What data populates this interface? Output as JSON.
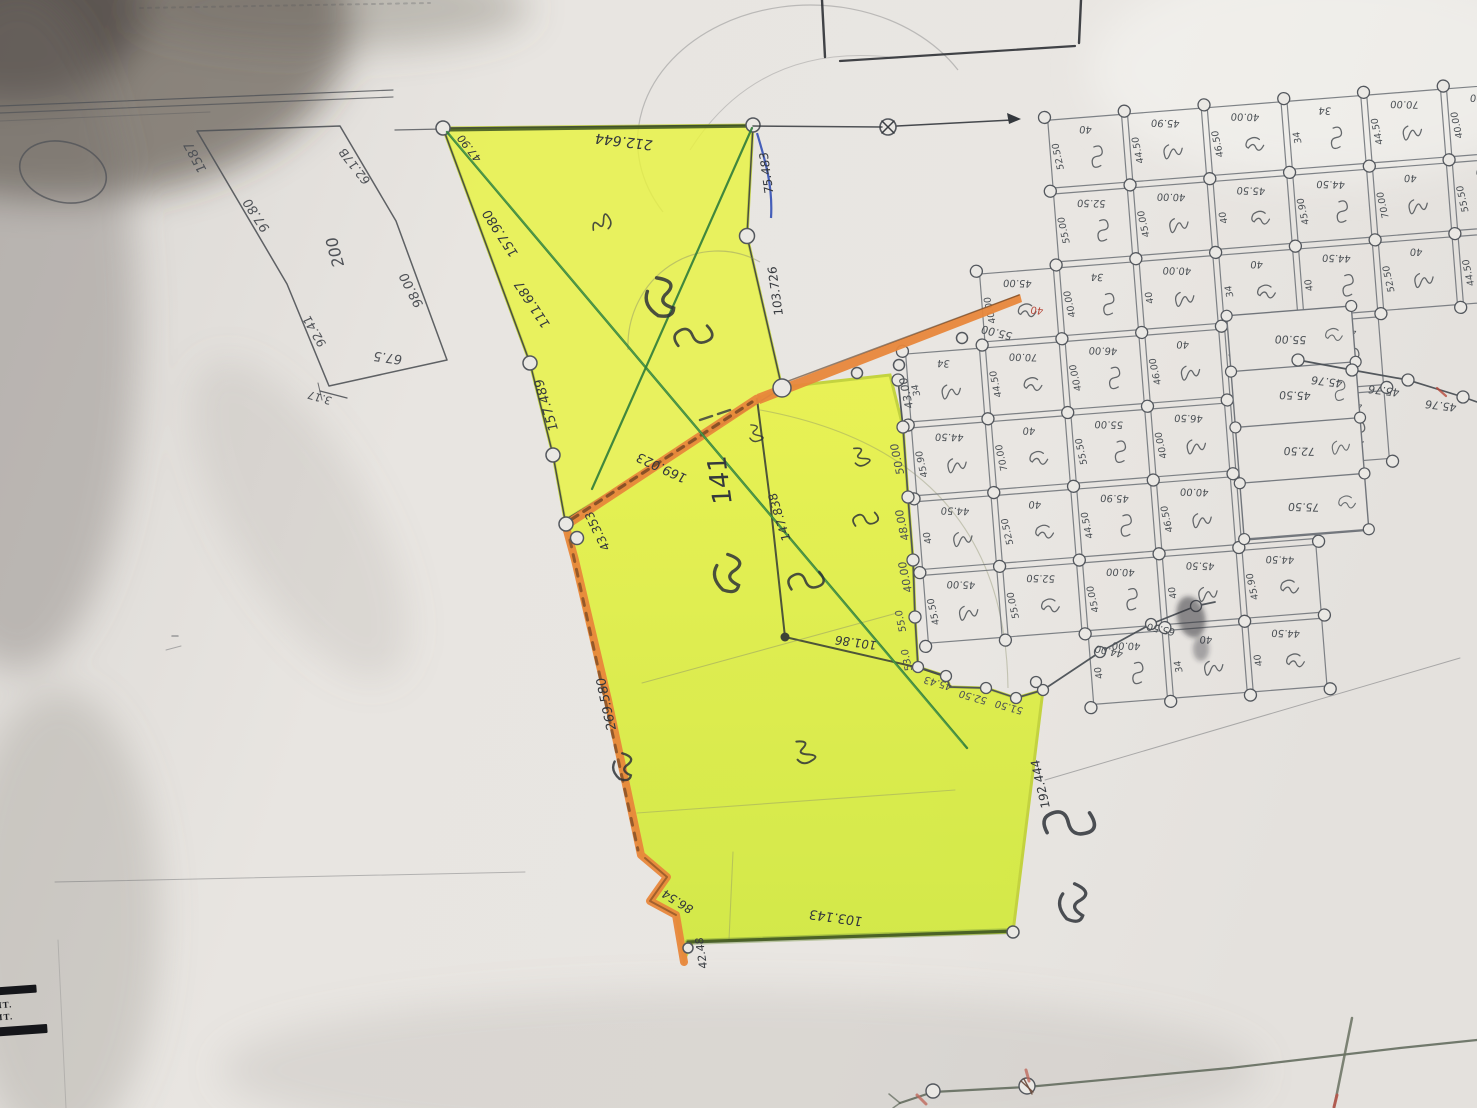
{
  "photo": {
    "description": "hand-drawn cadastral survey map, highlighted parcels"
  },
  "colors": {
    "paper": "#e7e4e0",
    "pencil": "#4f5257",
    "ink": "#34383d",
    "gridInk": "#4b5055",
    "yellow": "#e9f43e",
    "yellowDeep": "#cfe92f",
    "orange": "#e8873b",
    "orangeDark": "#744522",
    "green": "#2f7d3a",
    "blue": "#3350b5",
    "darkGreenEdge": "#3d5422",
    "red": "#b84a3c"
  },
  "stamp": {
    "line1": "ΔIT.",
    "line2": "ΔIT."
  },
  "labels": [
    {
      "t": "1587",
      "x": 196,
      "y": 157,
      "r": 242,
      "s": 13,
      "c": "pencil"
    },
    {
      "t": "97.80",
      "x": 257,
      "y": 215,
      "r": 237,
      "s": 13,
      "c": "pencil"
    },
    {
      "t": "62.17B",
      "x": 355,
      "y": 166,
      "r": 232,
      "s": 12,
      "c": "pencil"
    },
    {
      "t": "200",
      "x": 336,
      "y": 252,
      "r": 255,
      "s": 16,
      "c": "pencil"
    },
    {
      "t": "98.00",
      "x": 412,
      "y": 290,
      "r": 243,
      "s": 13,
      "c": "pencil"
    },
    {
      "t": "92.41",
      "x": 315,
      "y": 331,
      "r": 240,
      "s": 12,
      "c": "pencil"
    },
    {
      "t": "67.5",
      "x": 388,
      "y": 357,
      "r": 188,
      "s": 13,
      "c": "pencil"
    },
    {
      "t": "3.17",
      "x": 320,
      "y": 397,
      "r": 196,
      "s": 11,
      "c": "pencil"
    },
    {
      "t": "212.644",
      "x": 624,
      "y": 141,
      "r": 187,
      "s": 14,
      "c": "ink"
    },
    {
      "t": "47.90",
      "x": 470,
      "y": 148,
      "r": 232,
      "s": 11,
      "c": "ink"
    },
    {
      "t": "157.980",
      "x": 501,
      "y": 233,
      "r": 237,
      "s": 13,
      "c": "ink"
    },
    {
      "t": "111.687",
      "x": 533,
      "y": 304,
      "r": 237,
      "s": 13,
      "c": "ink"
    },
    {
      "t": "157.489",
      "x": 547,
      "y": 405,
      "r": 253,
      "s": 13,
      "c": "ink"
    },
    {
      "t": "75.483",
      "x": 767,
      "y": 173,
      "r": 262,
      "s": 12,
      "c": "ink"
    },
    {
      "t": "103.726",
      "x": 776,
      "y": 291,
      "r": 262,
      "s": 12,
      "c": "ink"
    },
    {
      "t": "169.023",
      "x": 662,
      "y": 467,
      "r": 205,
      "s": 13,
      "c": "ink"
    },
    {
      "t": "43.353",
      "x": 598,
      "y": 531,
      "r": 244,
      "s": 12,
      "c": "ink"
    },
    {
      "t": "141",
      "x": 721,
      "y": 480,
      "r": 262,
      "s": 26,
      "c": "ink"
    },
    {
      "t": "147.838",
      "x": 780,
      "y": 517,
      "r": 253,
      "s": 12,
      "c": "ink"
    },
    {
      "t": "101.86",
      "x": 856,
      "y": 642,
      "r": 188,
      "s": 12,
      "c": "ink"
    },
    {
      "t": "269.580",
      "x": 607,
      "y": 704,
      "r": 258,
      "s": 13,
      "c": "ink"
    },
    {
      "t": "192.444",
      "x": 1041,
      "y": 784,
      "r": 257,
      "s": 12,
      "c": "ink"
    },
    {
      "t": "86.54",
      "x": 678,
      "y": 901,
      "r": 212,
      "s": 12,
      "c": "ink"
    },
    {
      "t": "42.48",
      "x": 702,
      "y": 953,
      "r": 262,
      "s": 11,
      "c": "ink"
    },
    {
      "t": "103.143",
      "x": 836,
      "y": 917,
      "r": 188,
      "s": 13,
      "c": "ink"
    },
    {
      "t": "55.00",
      "x": 997,
      "y": 332,
      "r": 194,
      "s": 11,
      "c": "gridInk"
    },
    {
      "t": "43.00",
      "x": 907,
      "y": 393,
      "r": 258,
      "s": 11,
      "c": "gridInk"
    },
    {
      "t": "50.00",
      "x": 898,
      "y": 459,
      "r": 258,
      "s": 11,
      "c": "gridInk"
    },
    {
      "t": "48.00",
      "x": 903,
      "y": 525,
      "r": 258,
      "s": 11,
      "c": "gridInk"
    },
    {
      "t": "40.00",
      "x": 906,
      "y": 577,
      "r": 258,
      "s": 11,
      "c": "gridInk"
    },
    {
      "t": "55.0",
      "x": 901,
      "y": 621,
      "r": 258,
      "s": 10,
      "c": "gridInk"
    },
    {
      "t": "53.0",
      "x": 907,
      "y": 660,
      "r": 258,
      "s": 10,
      "c": "gridInk"
    },
    {
      "t": "45.76",
      "x": 1327,
      "y": 381,
      "r": 187,
      "s": 11,
      "c": "gridInk"
    },
    {
      "t": "45.76",
      "x": 1384,
      "y": 390,
      "r": 187,
      "s": 11,
      "c": "gridInk"
    },
    {
      "t": "45.76",
      "x": 1441,
      "y": 405,
      "r": 187,
      "s": 11,
      "c": "gridInk"
    },
    {
      "t": "45.43",
      "x": 938,
      "y": 683,
      "r": 196,
      "s": 10,
      "c": "gridInk"
    },
    {
      "t": "52.50",
      "x": 973,
      "y": 697,
      "r": 196,
      "s": 10,
      "c": "gridInk"
    },
    {
      "t": "51.50",
      "x": 1009,
      "y": 707,
      "r": 196,
      "s": 10,
      "c": "gridInk"
    },
    {
      "t": "44.00",
      "x": 1109,
      "y": 651,
      "r": 192,
      "s": 10,
      "c": "gridInk"
    },
    {
      "t": "65.50",
      "x": 1161,
      "y": 629,
      "r": 192,
      "s": 10,
      "c": "gridInk"
    },
    {
      "t": "40",
      "x": 1037,
      "y": 310,
      "r": 187,
      "s": 10,
      "c": "red"
    }
  ],
  "grid": {
    "occupancy": [
      "..XXXXXXX",
      "..XXXXXXX",
      ".XXXXXXXX",
      "XXXXXX...",
      "XXXXXX...",
      "XXXXX....",
      "XXXXX....",
      "..XXX...."
    ],
    "cell_values": [
      "40",
      "44.50",
      "40",
      "45.90",
      "40.00",
      "34",
      "70.00",
      "46.00",
      "40",
      "55.50",
      "45.00",
      "52.50",
      "40.00",
      "45.50",
      "44.50",
      "40",
      "55.00",
      "46.50",
      "40.00",
      "45.00",
      "34",
      "40.00"
    ],
    "tall_plot_values": [
      "55.00",
      "45.50",
      "72.50",
      "75.50"
    ]
  }
}
